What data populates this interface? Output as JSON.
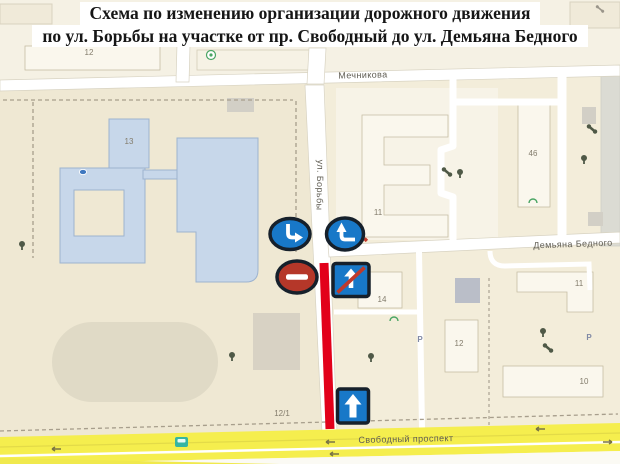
{
  "title": {
    "line1": "Схема по изменению организации дорожного движения",
    "line2": "по ул. Борьбы на участке от пр. Свободный до ул. Демьяна Бедного"
  },
  "map": {
    "streets": {
      "mechnikova": "Мечникова",
      "borby": "ул. Борьбы",
      "demyana_bednogo": "Демьяна Бедного",
      "svobodny": "Свободный проспект"
    },
    "building_labels": {
      "b12_top": "12",
      "b13": "13",
      "b11_left": "11",
      "b46": "46",
      "b14": "14",
      "b12_center": "12",
      "b11_right": "11",
      "b10": "10",
      "b12_1": "12/1"
    },
    "parking_label": "P"
  },
  "signs": {
    "turn_right": "mandatory turn (blue circle, bent arrow down-right)",
    "turn_left_up": "mandatory turn (blue circle, bent arrow left-up)",
    "no_entry": "no entry (red circle, white bar)",
    "end_one_way": "end of one-way road (blue square, white arrow, red slash)",
    "one_way": "one-way road (blue square, white up arrow)"
  },
  "colors": {
    "map_background": "#f5f1e4",
    "school_block": "#efe8d3",
    "residential_block": "#f3edda",
    "road_white": "#ffffff",
    "road_yellow": "#f5ee4e",
    "route_red": "#e2001a",
    "sign_blue": "#1878c8",
    "sign_red": "#b53729",
    "sign_border": "#16202b",
    "building_blue": "#c7d7ea",
    "building_cream": "#faf7ed",
    "stadium_fill": "#e0dac6"
  }
}
